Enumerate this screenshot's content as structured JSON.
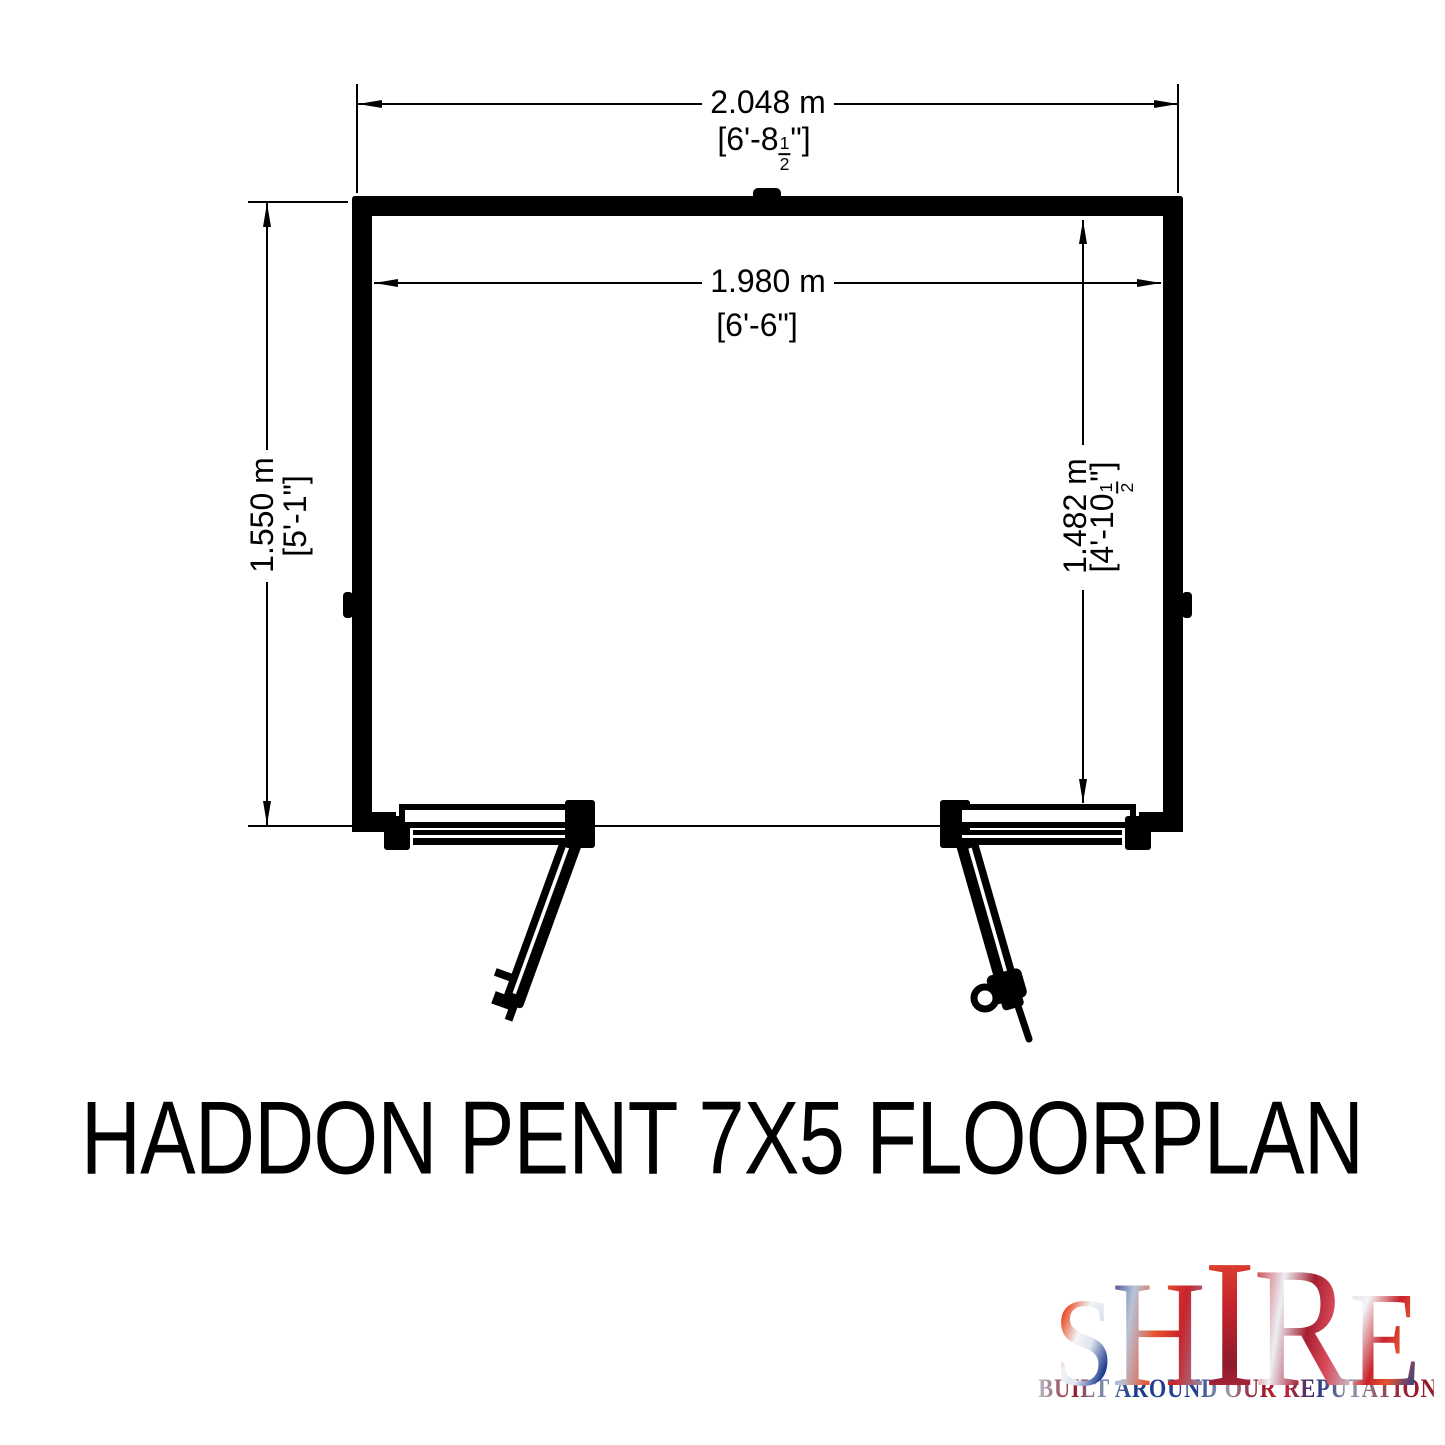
{
  "document": {
    "background_color": "#ffffff",
    "line_color": "#000000"
  },
  "plan": {
    "dimensions": {
      "outer_width": {
        "meters": "2.048 m",
        "imperial_prefix": "[6'-8",
        "fraction_numerator": "1",
        "fraction_denominator": "2",
        "imperial_suffix": "\"]"
      },
      "inner_width": {
        "meters": "1.980 m",
        "imperial": "[6'-6\"]"
      },
      "outer_depth": {
        "meters": "1.550 m",
        "imperial": "[5'-1\"]"
      },
      "inner_depth": {
        "meters": "1.482 m",
        "imperial_prefix": "[4'-10",
        "fraction_numerator": "1",
        "fraction_denominator": "2",
        "imperial_suffix": "\"]"
      }
    }
  },
  "title": "HADDON PENT 7X5 FLOORPLAN",
  "logo": {
    "brand": "SHIRE",
    "letters": [
      "S",
      "H",
      "I",
      "R",
      "E"
    ],
    "tagline": "BUILT AROUND OUR REPUTATION",
    "colors": {
      "red": "#c8232c",
      "dark_red": "#8e1b2c",
      "orange_red": "#e8542e",
      "blue": "#1e3e8f",
      "dark_blue": "#27337a",
      "silver": "#c3c9d5"
    }
  }
}
